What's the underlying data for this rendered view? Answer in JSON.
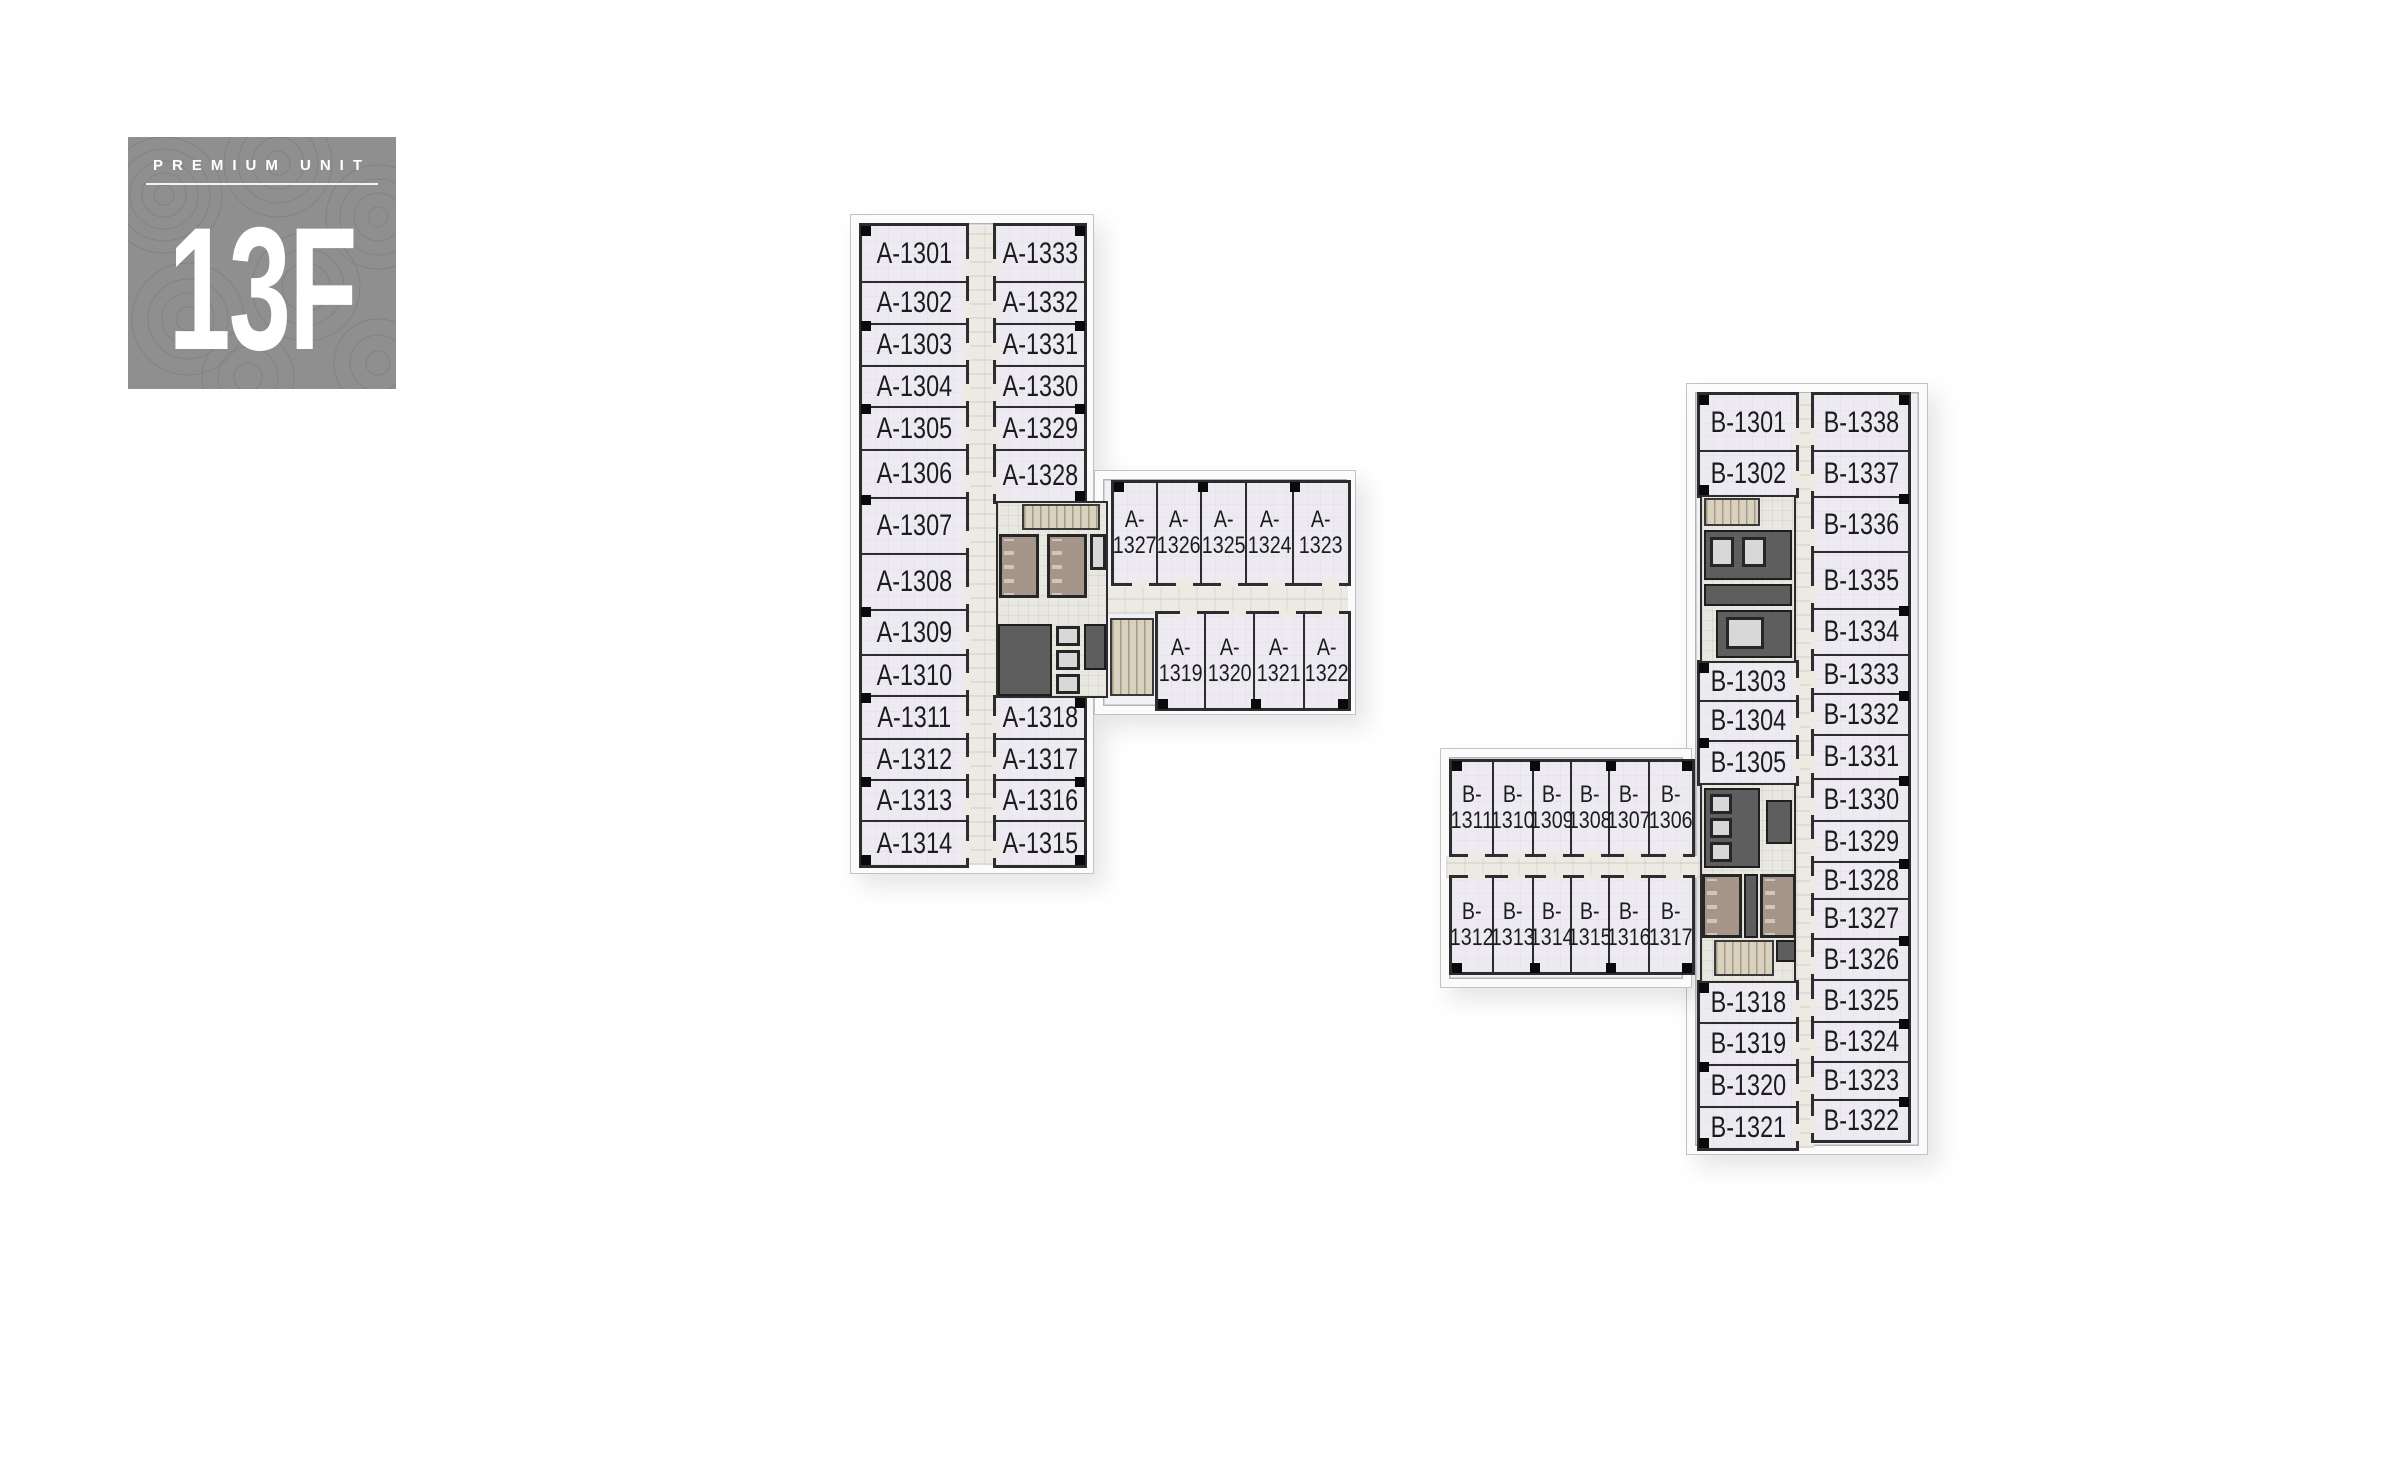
{
  "badge": {
    "eyebrow": "PREMIUM UNIT",
    "floor": "13F",
    "bg_color": "#8f8f8f",
    "text_color": "#ffffff"
  },
  "building_a": {
    "left_column": [
      "A-1301",
      "A-1302",
      "A-1303",
      "A-1304",
      "A-1305",
      "A-1306",
      "A-1307",
      "A-1308",
      "A-1309",
      "A-1310",
      "A-1311",
      "A-1312",
      "A-1313",
      "A-1314"
    ],
    "right_column_top": [
      "A-1333",
      "A-1332",
      "A-1331",
      "A-1330",
      "A-1329",
      "A-1328"
    ],
    "right_column_bottom": [
      "A-1318",
      "A-1317",
      "A-1316",
      "A-1315"
    ],
    "wing_top": [
      "A-1327",
      "A-1326",
      "A-1325",
      "A-1324",
      "A-1323"
    ],
    "wing_bottom": [
      "A-1319",
      "A-1320",
      "A-1321",
      "A-1322"
    ]
  },
  "building_b": {
    "left_top": [
      "B-1301",
      "B-1302"
    ],
    "left_mid": [
      "B-1303",
      "B-1304",
      "B-1305"
    ],
    "left_bottom": [
      "B-1318",
      "B-1319",
      "B-1320",
      "B-1321"
    ],
    "wing_top": [
      "B-1311",
      "B-1310",
      "B-1309",
      "B-1308",
      "B-1307",
      "B-1306"
    ],
    "wing_bottom": [
      "B-1312",
      "B-1313",
      "B-1314",
      "B-1315",
      "B-1316",
      "B-1317"
    ],
    "right_column": [
      "B-1338",
      "B-1337",
      "B-1336",
      "B-1335",
      "B-1334",
      "B-1333",
      "B-1332",
      "B-1331",
      "B-1330",
      "B-1329",
      "B-1328",
      "B-1327",
      "B-1326",
      "B-1325",
      "B-1324",
      "B-1323",
      "B-1322"
    ]
  },
  "colors": {
    "unit_fill": "#edeaf2",
    "wall": "#2d2d2d",
    "corridor": "#eceae3",
    "washroom": "#a59689",
    "stairs": "#d9d1bd",
    "elevator": "#d8d8d8",
    "core_room": "#5e5e5e",
    "badge_gray": "#8f8f8f"
  }
}
